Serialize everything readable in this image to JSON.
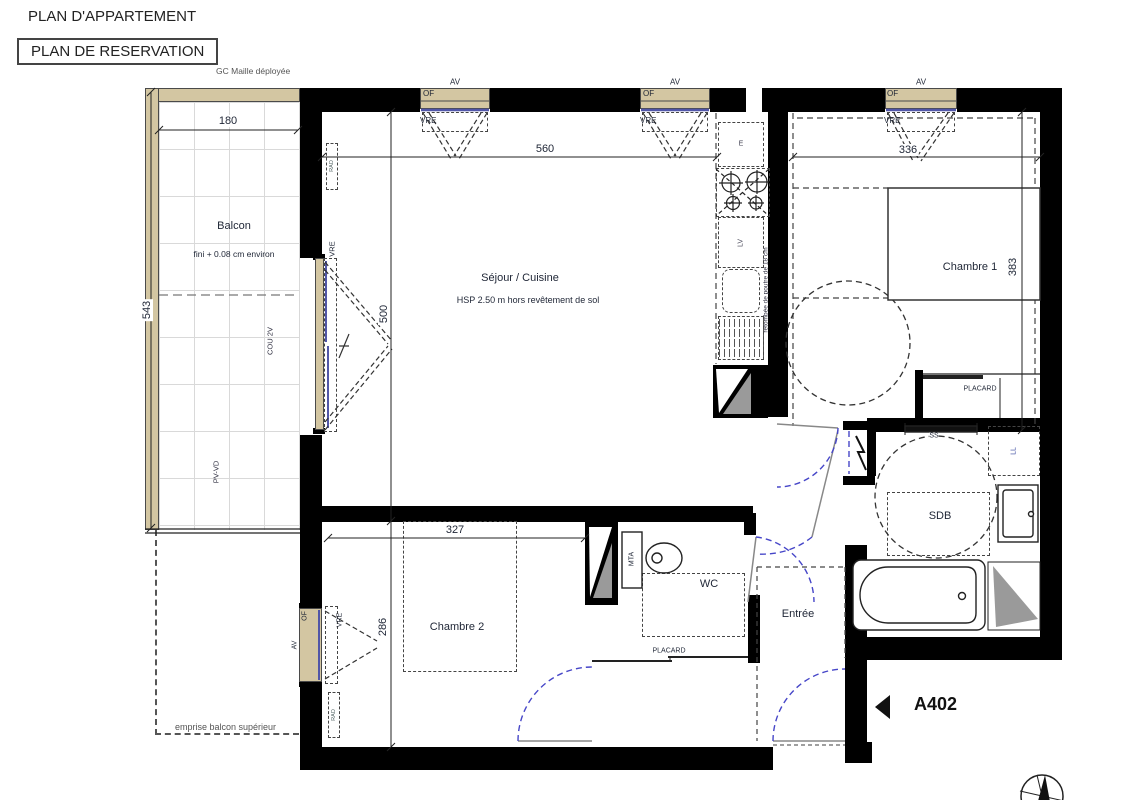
{
  "header": {
    "title": "PLAN D'APPARTEMENT",
    "subtitle": "PLAN DE RESERVATION",
    "construction_note": "GC Maille déployée"
  },
  "balcony": {
    "name": "Balcon",
    "finish_note": "fini + 0.08 cm environ",
    "width_cm": "180",
    "depth_cm": "543",
    "sliding_bay_label": "COU 2V",
    "rail_label": "PV-VD",
    "upper_balcony_note": "emprise balcon supérieur"
  },
  "living": {
    "name": "Séjour / Cuisine",
    "ceiling_note": "HSP 2.50 m hors revêtement de sol",
    "width_cm": "560",
    "depth_cm": "500",
    "beam_note": "retombée de poutre de 18 cm"
  },
  "kitchen": {
    "extract_label": "E",
    "dishwasher_label": "LV"
  },
  "bedroom1": {
    "name": "Chambre 1",
    "width_cm": "336",
    "depth_cm": "383",
    "closet_label": "PLACARD"
  },
  "bedroom2": {
    "name": "Chambre 2",
    "width_cm": "327",
    "depth_cm": "286"
  },
  "bathroom": {
    "name": "SDB",
    "towel_rail_label": "SS",
    "washer_label": "LL"
  },
  "wc": {
    "name": "WC",
    "duct_label": "MTA",
    "closet_label": "PLACARD"
  },
  "entry": {
    "name": "Entrée"
  },
  "windows": {
    "av": "AV",
    "of": "OF",
    "vre": "VRE"
  },
  "radiator_label": "RAD",
  "unit": {
    "number": "A402"
  },
  "colors": {
    "wall": "#000000",
    "joinery_fill": "#d3c6a2",
    "glazing": "#5156a8",
    "door_swing": "#4646c8"
  }
}
